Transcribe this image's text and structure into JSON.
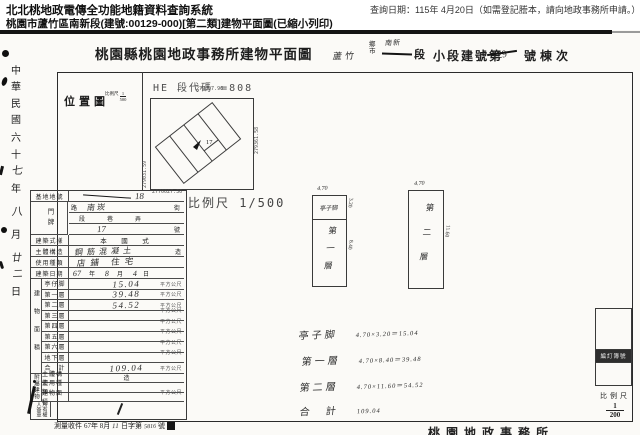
{
  "header": {
    "system_title": "北北桃地政電傳全功能地籍資料查詢系統",
    "query_date": "查詢日期：115年 4月20日（如需登記謄本，請向地政事務所申請。）",
    "doc_subtitle": "桃園市蘆竹區南新段(建號:00129-000)[第二類]建物平面圖(已縮小列印)"
  },
  "title_row": {
    "office_title": "桃園縣桃園地政事務所建物平面圖",
    "township_hand": "蘆竹",
    "township_unit_top": "鄉",
    "township_unit_bottom": "市",
    "section_hand": "南新",
    "section_unit": "段",
    "lot_prefix": "小段建號第",
    "lot_number_hand": "129",
    "lot_suffix": "號棟次"
  },
  "date_column": {
    "text": "中華民國六十七年八月廿二日"
  },
  "location_map": {
    "label": "位置圖",
    "scale_label": "比例尺",
    "scale_num": "1",
    "scale_den": "500",
    "code_text": "HE 段代碼 =808",
    "coord_top": "277007.96",
    "coord_left": "279031.59",
    "coord_right": "279361.58",
    "coord_bottom": "2770027.30",
    "parcel_number": "17",
    "big_scale_text": "比例尺 1/500"
  },
  "form": {
    "site_lot_label": "基地地號",
    "site_lot_value": "18",
    "door_label": "門牌",
    "street_unit1": "路",
    "street_hand": "南崁",
    "street_unit2": "街",
    "lane_units": "段　巷　弄",
    "number_hand": "17",
    "number_unit": "號",
    "style_label": "建築式樣",
    "style_value": "本　國　式",
    "structure_label": "主體構造",
    "structure_value": "鋼筋混凝土",
    "structure_unit": "造",
    "usage_label": "使用種類",
    "usage_value": "店鋪 住宅",
    "date_label": "建築日期",
    "date_y": "67",
    "date_y_unit": "年",
    "date_m": "8",
    "date_m_unit": "月",
    "date_d": "4",
    "date_d_unit": "日",
    "area_group_label": "建物面積",
    "areas": [
      {
        "label": "亭仔脚",
        "value": "15.04",
        "unit": "平方公尺"
      },
      {
        "label": "第一層",
        "value": "39.48",
        "unit": "平方公尺"
      },
      {
        "label": "第二層",
        "value": "54.52",
        "unit": "平方公尺"
      },
      {
        "label": "第三層",
        "value": "",
        "unit": "平方公尺"
      },
      {
        "label": "第四層",
        "value": "",
        "unit": "平方公尺"
      },
      {
        "label": "第五層",
        "value": "",
        "unit": "平方公尺"
      },
      {
        "label": "第六層",
        "value": "",
        "unit": "平方公尺"
      },
      {
        "label": "地下層",
        "value": "",
        "unit": "平方公尺"
      },
      {
        "label": "合　計",
        "value": "109.04",
        "unit": "平方公尺"
      }
    ],
    "attached_group_label": "附屬建物",
    "attached": [
      {
        "label": "主體構造",
        "value": "",
        "unit": "造"
      },
      {
        "label": "使用種類",
        "value": "",
        "unit": ""
      },
      {
        "label": "建物面積",
        "value": "",
        "unit": "平方公尺"
      }
    ],
    "owner_label": "所有權人簽章"
  },
  "plan": {
    "rect1": {
      "top_label": "亭子脚",
      "top_dim": "4.70",
      "top_side_dim": "3.20",
      "main_label": "第一層",
      "main_side_dim": "8.40"
    },
    "rect2": {
      "label": "第二層",
      "top_dim": "4.70",
      "side_dim": "11.60"
    },
    "calcs": [
      {
        "label": "亭子脚",
        "eq": "4.70×3.20＝15.04"
      },
      {
        "label": "第一層",
        "eq": "4.70×8.40＝39.48"
      },
      {
        "label": "第二層",
        "eq": "4.70×11.60＝54.52"
      },
      {
        "label": "合　計",
        "eq": "109.04"
      }
    ]
  },
  "footer": {
    "receipt_parts": [
      "測量收件",
      "67年 8月",
      "11",
      "日字第",
      "5816",
      "號"
    ],
    "office": "桃園地政事務所",
    "book_label": "編訂簿號",
    "scale_label": "比例尺",
    "scale_num": "1",
    "scale_den": "200"
  }
}
